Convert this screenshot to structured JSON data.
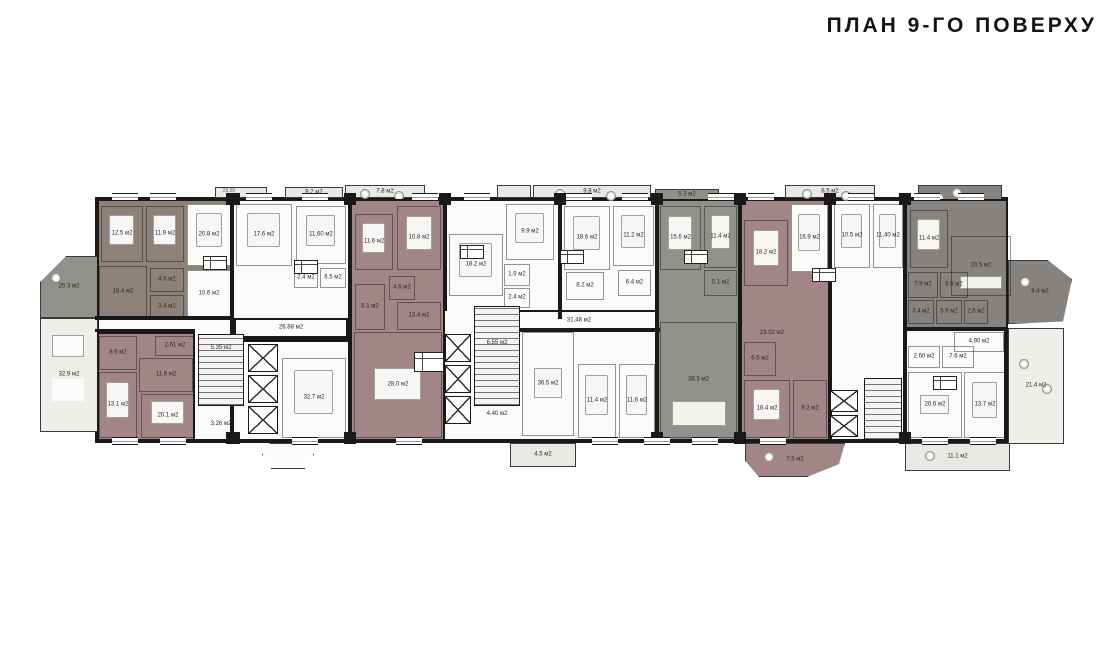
{
  "title": "ПЛАН 9-ГО ПОВЕРХУ",
  "colors": {
    "wall": "#191919",
    "white": "#fcfcfb",
    "light": "#e9e8e5",
    "lighter": "#efeeea",
    "taupe": "#8d8279",
    "mauve": "#a18587",
    "gray": "#92908b",
    "dark": "#868280"
  },
  "plan": {
    "outline": {
      "x": 95,
      "y": 197,
      "w": 913,
      "h": 246
    },
    "units": [
      {
        "name": "unit-taupe-left",
        "x": 97,
        "y": 199,
        "w": 135,
        "h": 121,
        "fill": "taupe"
      },
      {
        "name": "unit-mauve-2",
        "x": 350,
        "y": 199,
        "w": 95,
        "h": 242,
        "fill": "mauve"
      },
      {
        "name": "unit-gray",
        "x": 657,
        "y": 199,
        "w": 83,
        "h": 242,
        "fill": "gray"
      },
      {
        "name": "unit-mauve-right",
        "x": 740,
        "y": 199,
        "w": 90,
        "h": 242,
        "fill": "mauve"
      },
      {
        "name": "unit-dark-topright",
        "x": 905,
        "y": 199,
        "w": 103,
        "h": 130,
        "fill": "dark"
      },
      {
        "name": "unit-mauve-bottomleft",
        "x": 97,
        "y": 332,
        "w": 98,
        "h": 109,
        "fill": "mauve"
      }
    ],
    "balconies": [
      {
        "name": "balcony-top-1",
        "x": 215,
        "y": 187,
        "w": 52,
        "h": 11,
        "fill": "light"
      },
      {
        "name": "balcony-top-2",
        "x": 285,
        "y": 187,
        "w": 58,
        "h": 11,
        "fill": "light",
        "label": "9.2 м2"
      },
      {
        "name": "balcony-top-3",
        "x": 345,
        "y": 185,
        "w": 80,
        "h": 13,
        "fill": "light",
        "label": "7.8 м2",
        "furn": [
          "plant",
          "plant"
        ]
      },
      {
        "name": "balcony-top-4",
        "x": 497,
        "y": 185,
        "w": 34,
        "h": 13,
        "fill": "light"
      },
      {
        "name": "balcony-top-5",
        "x": 533,
        "y": 185,
        "w": 118,
        "h": 13,
        "fill": "light",
        "label": "9.8 м2",
        "furn": [
          "plant",
          "plant"
        ]
      },
      {
        "name": "balcony-top-6",
        "x": 655,
        "y": 189,
        "w": 64,
        "h": 11,
        "fill": "gray",
        "label": "5.3 м2"
      },
      {
        "name": "balcony-top-7",
        "x": 785,
        "y": 185,
        "w": 90,
        "h": 13,
        "fill": "light",
        "label": "8.5 м2",
        "furn": [
          "plant",
          "plant"
        ]
      },
      {
        "name": "terrace-top-right",
        "x": 918,
        "y": 185,
        "w": 84,
        "h": 28,
        "fill": "dark",
        "furn": [
          "plant",
          "plant",
          "plant"
        ]
      },
      {
        "name": "balcony-left-upper",
        "x": 40,
        "y": 256,
        "w": 58,
        "h": 62,
        "fill": "gray",
        "label": "20.3 м2",
        "clip": "polygon(0 42%, 45% 0, 100% 0, 100% 100%, 0 100%)",
        "furn": [
          "plant"
        ]
      },
      {
        "name": "terrace-left-lower",
        "x": 40,
        "y": 318,
        "w": 58,
        "h": 114,
        "fill": "lighter",
        "label": "32.9 м2",
        "furn": [
          "tables2"
        ]
      },
      {
        "name": "balcony-bottom-small",
        "x": 262,
        "y": 443,
        "w": 52,
        "h": 26,
        "fill": "white",
        "clip": "polygon(15% 0, 85% 0, 100% 45%, 82% 100%, 18% 100%, 0 45%)"
      },
      {
        "name": "balcony-bottom-4",
        "x": 510,
        "y": 443,
        "w": 66,
        "h": 24,
        "fill": "light",
        "label": "4.5 м2"
      },
      {
        "name": "balcony-bottom-mauve",
        "x": 745,
        "y": 443,
        "w": 100,
        "h": 34,
        "fill": "mauve",
        "label": "7.5 м2",
        "clip": "polygon(0 0, 100% 0, 94% 62%, 62% 100%, 14% 100%, 0 52%)",
        "furn": [
          "plant"
        ]
      },
      {
        "name": "balcony-bottom-right",
        "x": 905,
        "y": 443,
        "w": 105,
        "h": 28,
        "fill": "light",
        "label": "11.1 м2",
        "furn": [
          "plant"
        ]
      },
      {
        "name": "terrace-right",
        "x": 1008,
        "y": 328,
        "w": 56,
        "h": 116,
        "fill": "lighter",
        "label": "21.4 м2",
        "furn": [
          "plant",
          "plant"
        ]
      },
      {
        "name": "balcony-right-angled",
        "x": 1008,
        "y": 260,
        "w": 64,
        "h": 64,
        "fill": "dark",
        "label": "8.4 м2",
        "clip": "polygon(0 0, 62% 0, 100% 30%, 86% 96%, 0 100%)",
        "furn": [
          "plant"
        ]
      }
    ],
    "corridors": [
      {
        "name": "corridor-left",
        "x": 234,
        "y": 318,
        "w": 114,
        "h": 20,
        "label": "26.88 м2"
      },
      {
        "name": "corridor-center",
        "x": 500,
        "y": 310,
        "w": 158,
        "h": 22,
        "label": "31.48 м2"
      }
    ],
    "rooms": [
      {
        "label": "12.5 м2",
        "x": 101,
        "y": 206,
        "w": 42,
        "h": 56,
        "furn": [
          "bed"
        ]
      },
      {
        "label": "11.9 м2",
        "x": 146,
        "y": 206,
        "w": 38,
        "h": 56,
        "furn": [
          "bed"
        ]
      },
      {
        "label": "18.4 м2",
        "x": 99,
        "y": 266,
        "w": 48,
        "h": 52
      },
      {
        "label": "4.6 м2",
        "x": 150,
        "y": 268,
        "w": 34,
        "h": 24
      },
      {
        "label": "3.4 м2",
        "x": 150,
        "y": 295,
        "w": 34,
        "h": 23
      },
      {
        "label": "20.8 м2",
        "x": 187,
        "y": 204,
        "w": 44,
        "h": 62,
        "fill": "white",
        "furn": [
          "bed"
        ]
      },
      {
        "label": "10.6 м2",
        "x": 187,
        "y": 270,
        "w": 44,
        "h": 48,
        "fill": "white"
      },
      {
        "label": "17.6 м2",
        "x": 236,
        "y": 204,
        "w": 56,
        "h": 62,
        "furn": [
          "bed"
        ]
      },
      {
        "label": "11.60 м2",
        "x": 296,
        "y": 206,
        "w": 50,
        "h": 58,
        "furn": [
          "bed"
        ]
      },
      {
        "label": "2.4 м2",
        "x": 294,
        "y": 268,
        "w": 24,
        "h": 20
      },
      {
        "label": "6.5 м2",
        "x": 320,
        "y": 268,
        "w": 26,
        "h": 20
      },
      {
        "label": "32.7 м2",
        "x": 282,
        "y": 358,
        "w": 64,
        "h": 80,
        "furn": [
          "bed"
        ]
      },
      {
        "label": "11.6 м2",
        "x": 355,
        "y": 214,
        "w": 38,
        "h": 56,
        "furn": [
          "bed"
        ]
      },
      {
        "label": "10.8 м2",
        "x": 397,
        "y": 206,
        "w": 44,
        "h": 64,
        "furn": [
          "bed"
        ]
      },
      {
        "label": "6.1 м2",
        "x": 355,
        "y": 284,
        "w": 30,
        "h": 46
      },
      {
        "label": "4.6 м2",
        "x": 389,
        "y": 276,
        "w": 26,
        "h": 24
      },
      {
        "label": "13.4 м2",
        "x": 397,
        "y": 302,
        "w": 44,
        "h": 28
      },
      {
        "label": "28.0 м2",
        "x": 354,
        "y": 332,
        "w": 88,
        "h": 106,
        "furn": [
          "table"
        ]
      },
      {
        "label": "9.9 м2",
        "x": 506,
        "y": 204,
        "w": 48,
        "h": 56,
        "furn": [
          "bed"
        ]
      },
      {
        "label": "18.2 м2",
        "x": 449,
        "y": 234,
        "w": 54,
        "h": 62,
        "furn": [
          "bed"
        ]
      },
      {
        "label": "1.9 м2",
        "x": 504,
        "y": 264,
        "w": 26,
        "h": 22
      },
      {
        "label": "2.4 м2",
        "x": 504,
        "y": 288,
        "w": 26,
        "h": 20
      },
      {
        "label": "18.6 м2",
        "x": 564,
        "y": 206,
        "w": 46,
        "h": 64,
        "furn": [
          "bed"
        ]
      },
      {
        "label": "11.2 м2",
        "x": 613,
        "y": 206,
        "w": 41,
        "h": 60,
        "furn": [
          "bed"
        ]
      },
      {
        "label": "8.2 м2",
        "x": 566,
        "y": 272,
        "w": 38,
        "h": 28
      },
      {
        "label": "6.4 м2",
        "x": 618,
        "y": 270,
        "w": 33,
        "h": 26
      },
      {
        "label": "36.5 м2",
        "x": 522,
        "y": 332,
        "w": 52,
        "h": 104,
        "furn": [
          "table"
        ]
      },
      {
        "label": "11.4 м2",
        "x": 578,
        "y": 364,
        "w": 38,
        "h": 74,
        "furn": [
          "bed"
        ]
      },
      {
        "label": "11.6 м2",
        "x": 619,
        "y": 364,
        "w": 36,
        "h": 74,
        "furn": [
          "bed"
        ]
      },
      {
        "label": "15.6 м2",
        "x": 660,
        "y": 206,
        "w": 41,
        "h": 64,
        "furn": [
          "bed"
        ]
      },
      {
        "label": "11.4 м2",
        "x": 704,
        "y": 206,
        "w": 33,
        "h": 62,
        "furn": [
          "bed"
        ]
      },
      {
        "label": "5.1 м2",
        "x": 704,
        "y": 270,
        "w": 33,
        "h": 26
      },
      {
        "label": "38.3 м2",
        "x": 660,
        "y": 322,
        "w": 77,
        "h": 116,
        "furn": [
          "sofa"
        ]
      },
      {
        "label": "18.2 м2",
        "x": 744,
        "y": 220,
        "w": 44,
        "h": 66,
        "furn": [
          "bed"
        ]
      },
      {
        "label": "16.9 м2",
        "x": 791,
        "y": 204,
        "w": 37,
        "h": 68,
        "fill": "white",
        "furn": [
          "bed"
        ]
      },
      {
        "label": "6.6 м2",
        "x": 744,
        "y": 342,
        "w": 32,
        "h": 34
      },
      {
        "label": "18.4 м2",
        "x": 744,
        "y": 380,
        "w": 46,
        "h": 58,
        "furn": [
          "bed"
        ]
      },
      {
        "label": "9.2 м2",
        "x": 793,
        "y": 380,
        "w": 34,
        "h": 58
      },
      {
        "label": "10.5 м2",
        "x": 834,
        "y": 204,
        "w": 36,
        "h": 64,
        "furn": [
          "bed"
        ]
      },
      {
        "label": "11.40 м2",
        "x": 873,
        "y": 204,
        "w": 30,
        "h": 64,
        "furn": [
          "bed"
        ]
      },
      {
        "label": "11.4 м2",
        "x": 910,
        "y": 210,
        "w": 38,
        "h": 58,
        "furn": [
          "bed"
        ]
      },
      {
        "label": "20.5 м2",
        "x": 951,
        "y": 236,
        "w": 60,
        "h": 60,
        "furn": [
          "sofa"
        ]
      },
      {
        "label": "7.9 м2",
        "x": 908,
        "y": 272,
        "w": 30,
        "h": 26
      },
      {
        "label": "6.9 м2",
        "x": 940,
        "y": 272,
        "w": 28,
        "h": 26
      },
      {
        "label": "3.4 м2",
        "x": 908,
        "y": 300,
        "w": 26,
        "h": 24
      },
      {
        "label": "5.9 м2",
        "x": 936,
        "y": 300,
        "w": 26,
        "h": 24
      },
      {
        "label": "2.6 м2",
        "x": 964,
        "y": 300,
        "w": 24,
        "h": 24
      },
      {
        "label": "2.60 м2",
        "x": 908,
        "y": 346,
        "w": 32,
        "h": 22
      },
      {
        "label": "7.6 м2",
        "x": 942,
        "y": 346,
        "w": 32,
        "h": 22
      },
      {
        "label": "4.90 м2",
        "x": 954,
        "y": 332,
        "w": 50,
        "h": 20
      },
      {
        "label": "20.6 м2",
        "x": 908,
        "y": 372,
        "w": 54,
        "h": 66,
        "furn": [
          "table"
        ]
      },
      {
        "label": "13.7 м2",
        "x": 964,
        "y": 372,
        "w": 42,
        "h": 66,
        "furn": [
          "bed"
        ]
      },
      {
        "label": "8.6 м2",
        "x": 99,
        "y": 336,
        "w": 38,
        "h": 34
      },
      {
        "label": "2.61 м2",
        "x": 155,
        "y": 336,
        "w": 40,
        "h": 20
      },
      {
        "label": "11.6 м2",
        "x": 139,
        "y": 358,
        "w": 54,
        "h": 34
      },
      {
        "label": "13.1 м2",
        "x": 99,
        "y": 372,
        "w": 38,
        "h": 66,
        "furn": [
          "bed"
        ]
      },
      {
        "label": "20.1 м2",
        "x": 141,
        "y": 394,
        "w": 54,
        "h": 44,
        "furn": [
          "bed"
        ]
      }
    ],
    "stairs": [
      {
        "name": "stair-core-left",
        "x": 198,
        "y": 334,
        "w": 46,
        "h": 72
      },
      {
        "name": "stair-core-center",
        "x": 474,
        "y": 306,
        "w": 46,
        "h": 100
      },
      {
        "name": "stair-core-right",
        "x": 864,
        "y": 378,
        "w": 38,
        "h": 62
      }
    ],
    "lifts": [
      {
        "x": 248,
        "y": 344,
        "w": 30,
        "h": 28
      },
      {
        "x": 248,
        "y": 375,
        "w": 30,
        "h": 28
      },
      {
        "x": 248,
        "y": 406,
        "w": 30,
        "h": 28
      },
      {
        "x": 445,
        "y": 334,
        "w": 26,
        "h": 28
      },
      {
        "x": 445,
        "y": 365,
        "w": 26,
        "h": 28
      },
      {
        "x": 445,
        "y": 396,
        "w": 26,
        "h": 28
      },
      {
        "x": 830,
        "y": 390,
        "w": 28,
        "h": 22
      },
      {
        "x": 830,
        "y": 415,
        "w": 28,
        "h": 22
      }
    ],
    "walls": [
      {
        "x": 230,
        "y": 199,
        "w": 4,
        "h": 242
      },
      {
        "x": 348,
        "y": 199,
        "w": 4,
        "h": 242
      },
      {
        "x": 443,
        "y": 199,
        "w": 4,
        "h": 112
      },
      {
        "x": 558,
        "y": 199,
        "w": 4,
        "h": 120
      },
      {
        "x": 655,
        "y": 199,
        "w": 4,
        "h": 242
      },
      {
        "x": 738,
        "y": 199,
        "w": 4,
        "h": 242
      },
      {
        "x": 828,
        "y": 199,
        "w": 4,
        "h": 242
      },
      {
        "x": 903,
        "y": 199,
        "w": 4,
        "h": 242
      },
      {
        "x": 95,
        "y": 316,
        "w": 137,
        "h": 4
      },
      {
        "x": 232,
        "y": 338,
        "w": 118,
        "h": 4
      },
      {
        "x": 95,
        "y": 329,
        "w": 100,
        "h": 3
      },
      {
        "x": 520,
        "y": 328,
        "w": 140,
        "h": 4
      },
      {
        "x": 905,
        "y": 327,
        "w": 103,
        "h": 4
      }
    ],
    "piers": [
      {
        "x": 226,
        "y": 193,
        "w": 14,
        "h": 12
      },
      {
        "x": 344,
        "y": 193,
        "w": 12,
        "h": 12
      },
      {
        "x": 439,
        "y": 193,
        "w": 12,
        "h": 12
      },
      {
        "x": 554,
        "y": 193,
        "w": 12,
        "h": 12
      },
      {
        "x": 651,
        "y": 193,
        "w": 12,
        "h": 12
      },
      {
        "x": 734,
        "y": 193,
        "w": 12,
        "h": 12
      },
      {
        "x": 824,
        "y": 193,
        "w": 12,
        "h": 12
      },
      {
        "x": 899,
        "y": 193,
        "w": 12,
        "h": 12
      },
      {
        "x": 226,
        "y": 432,
        "w": 14,
        "h": 12
      },
      {
        "x": 344,
        "y": 432,
        "w": 12,
        "h": 12
      },
      {
        "x": 651,
        "y": 432,
        "w": 12,
        "h": 12
      },
      {
        "x": 734,
        "y": 432,
        "w": 12,
        "h": 12
      },
      {
        "x": 899,
        "y": 432,
        "w": 12,
        "h": 12
      }
    ],
    "windows": {
      "top_y": 193,
      "bottom_y": 437,
      "top": [
        112,
        150,
        246,
        302,
        412,
        464,
        566,
        622,
        708,
        748,
        848,
        914,
        958
      ],
      "bottom": [
        112,
        160,
        292,
        396,
        592,
        644,
        692,
        760,
        922,
        970
      ]
    },
    "info_boxes": [
      {
        "x": 203,
        "y": 256,
        "w": 24,
        "h": 14
      },
      {
        "x": 294,
        "y": 260,
        "w": 24,
        "h": 14
      },
      {
        "x": 460,
        "y": 245,
        "w": 24,
        "h": 14
      },
      {
        "x": 560,
        "y": 250,
        "w": 24,
        "h": 14
      },
      {
        "x": 684,
        "y": 250,
        "w": 24,
        "h": 14
      },
      {
        "x": 812,
        "y": 268,
        "w": 24,
        "h": 14
      },
      {
        "x": 414,
        "y": 352,
        "w": 30,
        "h": 20
      },
      {
        "x": 933,
        "y": 376,
        "w": 24,
        "h": 14
      }
    ],
    "labels": [
      {
        "text": "5.35 м2",
        "x": 221,
        "y": 348
      },
      {
        "text": "3.26 м2",
        "x": 221,
        "y": 424
      },
      {
        "text": "6.55 м2",
        "x": 497,
        "y": 343
      },
      {
        "text": "4.40 м2",
        "x": 497,
        "y": 414
      },
      {
        "text": "23.02 м2",
        "x": 772,
        "y": 333
      },
      {
        "text": "29.85",
        "x": 229,
        "y": 191,
        "dim": true
      }
    ]
  }
}
